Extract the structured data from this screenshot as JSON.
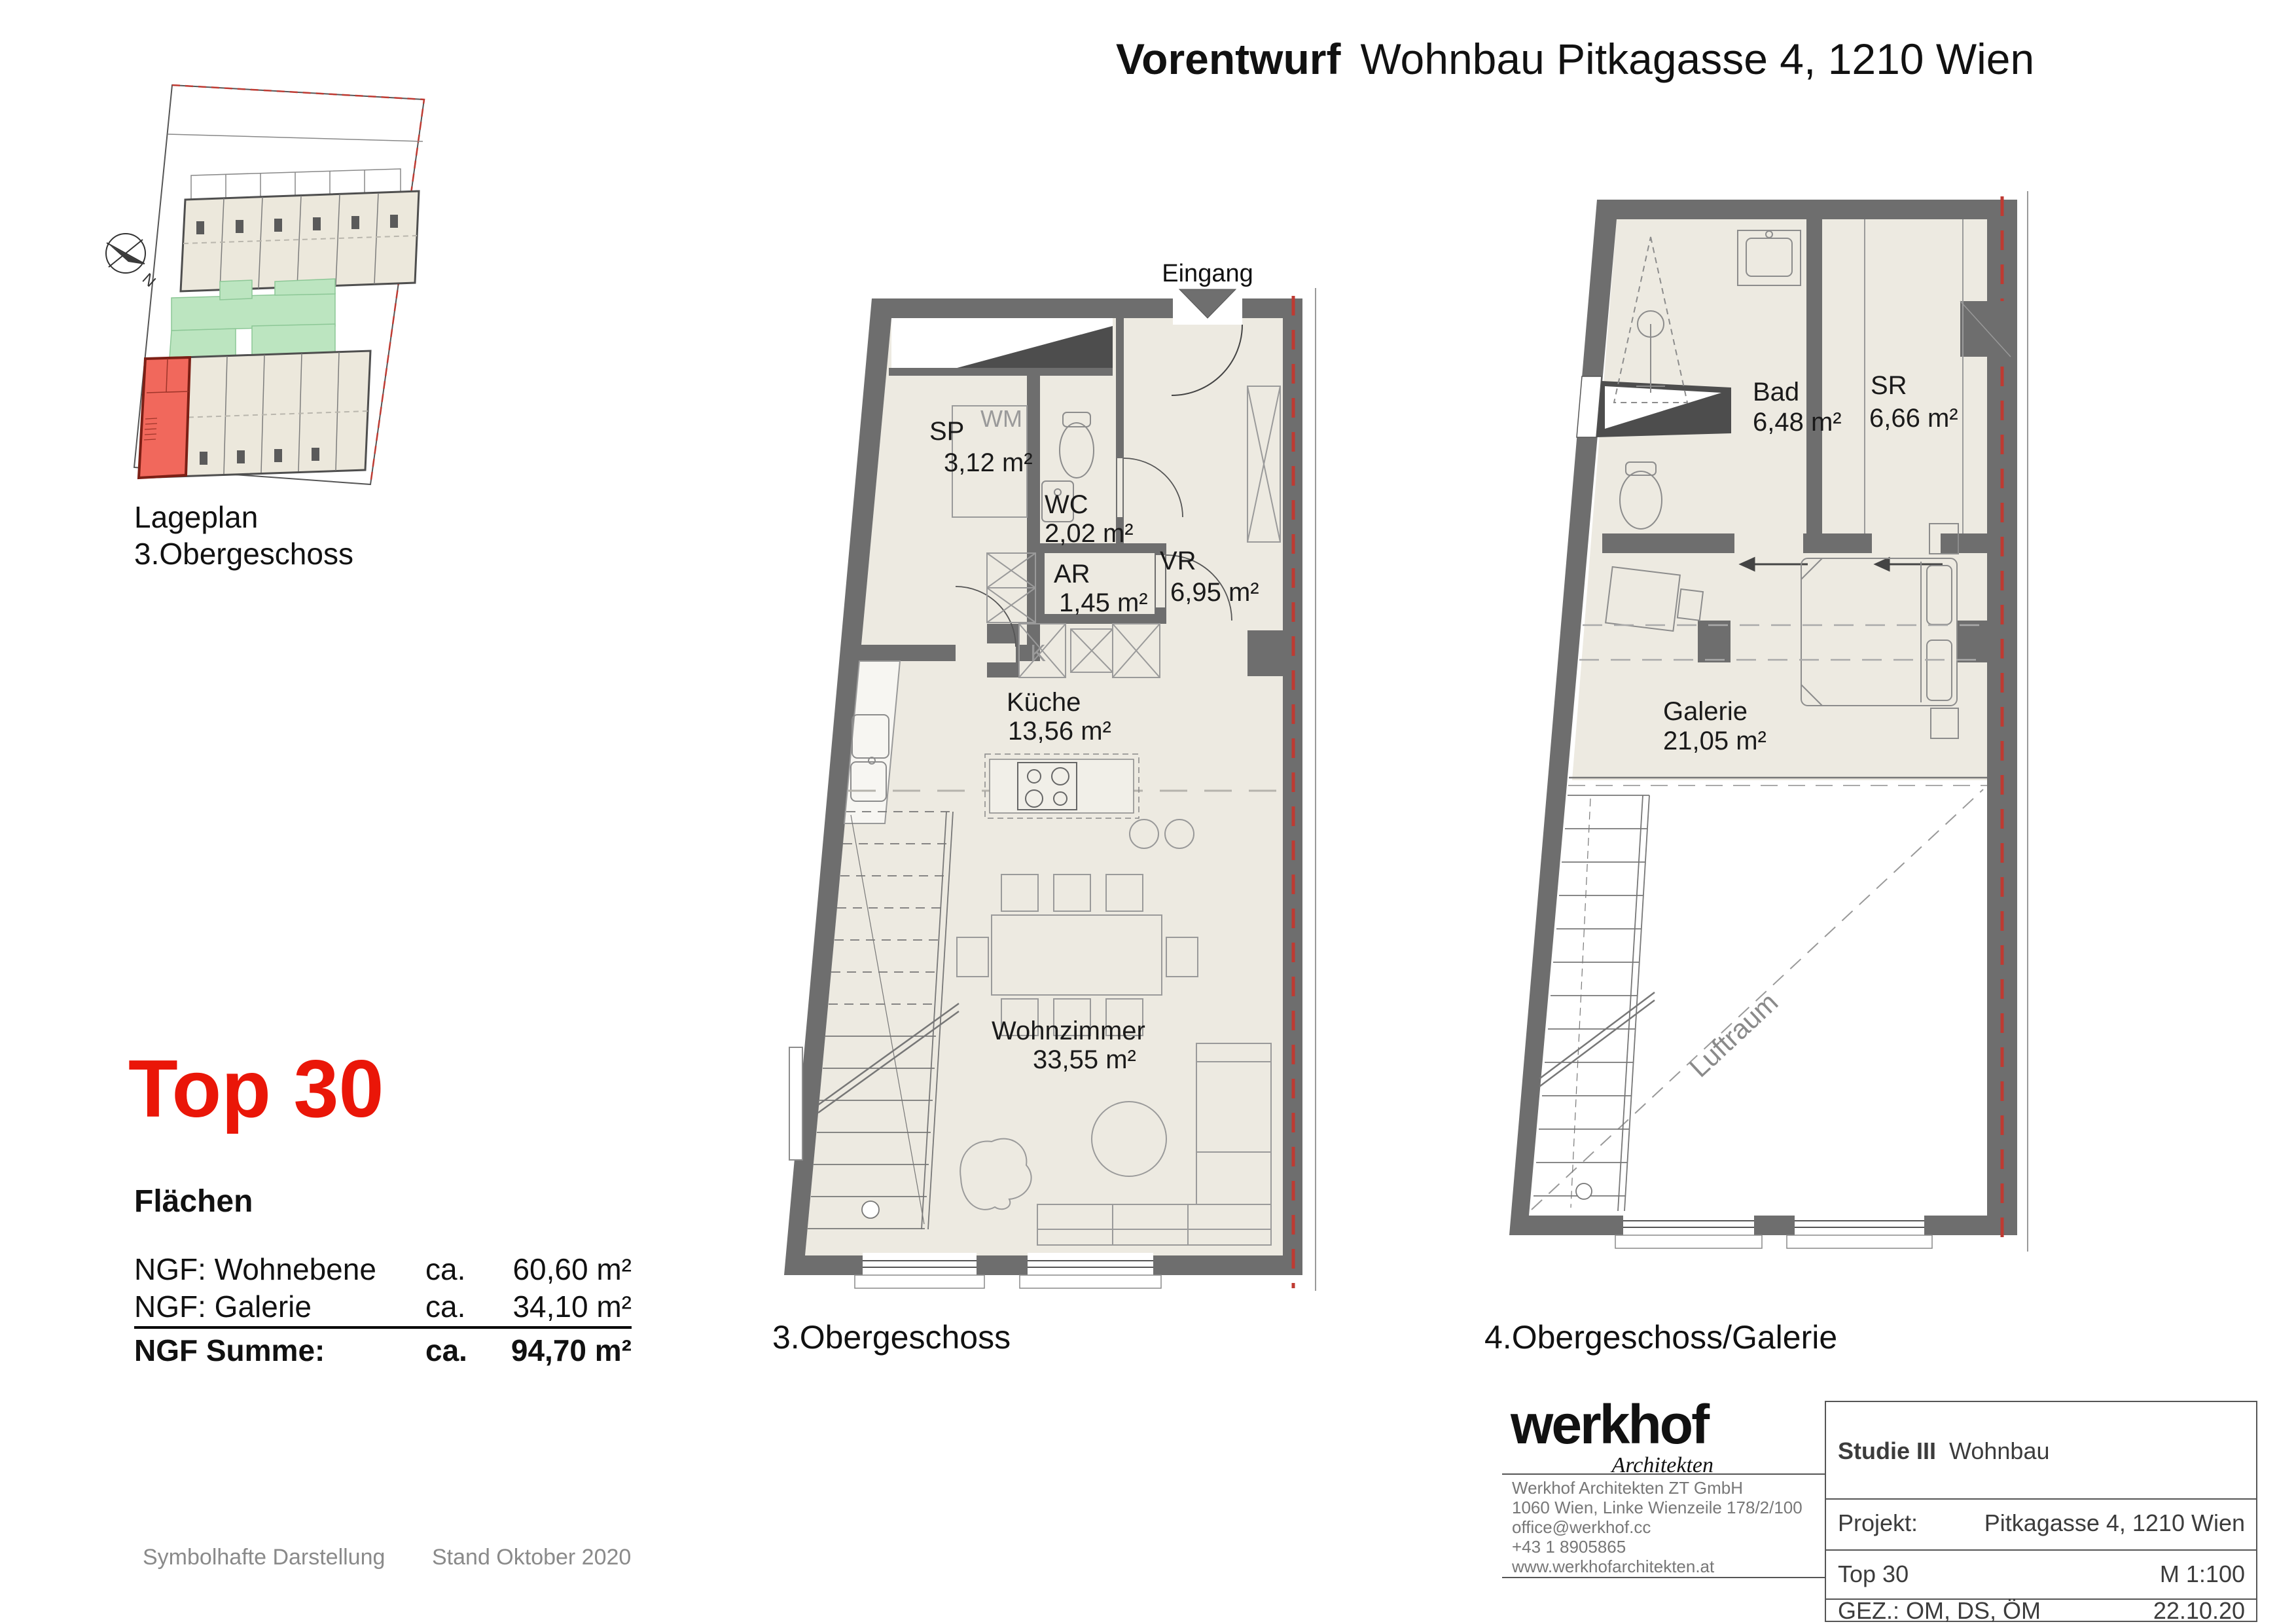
{
  "header": {
    "title_bold": "Vorentwurf",
    "title_rest": "Wohnbau Pitkagasse 4, 1210 Wien"
  },
  "siteplan": {
    "caption1": "Lageplan",
    "caption2": "3.Obergeschoss",
    "north": "N"
  },
  "unit": {
    "title": "Top 30",
    "heading": "Flächen",
    "rows": [
      {
        "label": "NGF: Wohnebene",
        "ca": "ca.",
        "value": "60,60 m²"
      },
      {
        "label": "NGF: Galerie",
        "ca": "ca.",
        "value": "34,10 m²"
      }
    ],
    "sum": {
      "label": "NGF Summe:",
      "ca": "ca.",
      "value": "94,70 m²"
    }
  },
  "plan1": {
    "caption": "3.Obergeschoss",
    "entrance": "Eingang",
    "rooms": [
      {
        "name": "SP",
        "area": "3,12 m²"
      },
      {
        "name": "WC",
        "area": "2,02 m²"
      },
      {
        "name": "VR",
        "area": "6,95 m²"
      },
      {
        "name": "AR",
        "area": "1,45 m²"
      },
      {
        "name": "Küche",
        "area": "13,56 m²"
      },
      {
        "name": "Wohnzimmer",
        "area": "33,55 m²"
      }
    ],
    "labels": {
      "wm": "WM",
      "k": "K"
    }
  },
  "plan2": {
    "caption": "4.Obergeschoss/Galerie",
    "rooms": [
      {
        "name": "Bad",
        "area": "6,48 m²"
      },
      {
        "name": "SR",
        "area": "6,66 m²"
      },
      {
        "name": "Galerie",
        "area": "21,05 m²"
      }
    ],
    "void_label": "Luftraum"
  },
  "footer": {
    "note1": "Symbolhafte Darstellung",
    "note2": "Stand Oktober 2020"
  },
  "titleblock": {
    "logo": "werkhof",
    "logo_sub": "Architekten",
    "address": [
      "Werkhof Architekten ZT GmbH",
      "1060 Wien, Linke Wienzeile 178/2/100",
      "office@werkhof.cc",
      "+43 1 8905865",
      "www.werkhofarchitekten.at"
    ],
    "study_bold": "Studie III",
    "study_rest": "Wohnbau",
    "projekt_label": "Projekt:",
    "projekt_value": "Pitkagasse 4, 1210 Wien",
    "top_label": "Top 30",
    "scale": "M 1:100",
    "gez": "GEZ.: OM, DS, ÖM",
    "date": "22.10.20"
  },
  "colors": {
    "accent_red": "#ea1608",
    "floor_beige": "#edeae1",
    "wall_gray": "#6e6e6e",
    "site_green": "#bce5c0",
    "unit_red": "#f1685c",
    "boundary_red": "#bf3a32"
  }
}
